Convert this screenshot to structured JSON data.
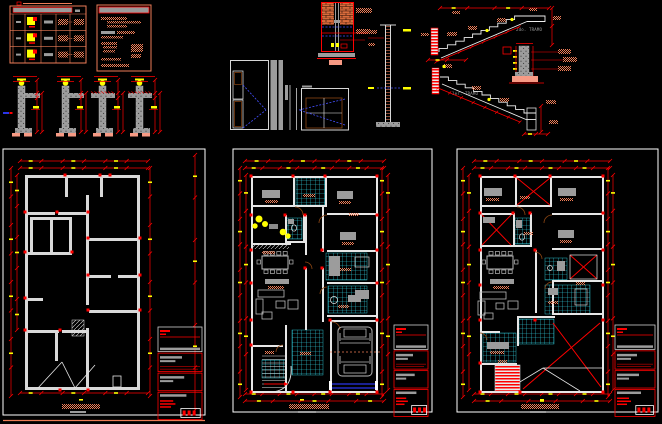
{
  "canvas": {
    "width": 662,
    "height": 424,
    "background": "#000000"
  },
  "palette": {
    "background": "#000000",
    "red": "#ff0000",
    "label_orange": "#ee7d57",
    "brick_orange": "#d96c3c",
    "salmon": "#f79a84",
    "yellow": "#ffff00",
    "cyan": "#35e0f2",
    "blue": "#2a35e8",
    "dash_blue": "#4450ff",
    "white": "#ffffff",
    "wall_white": "#e6e6e6",
    "gray": "#9d9d9d",
    "furniture_gray": "#b8b8b8",
    "dark_gray": "#6f6f6f",
    "maroon": "#8b4513",
    "text_gray": "#9d9d9d"
  },
  "labels": {
    "stair_flight_2": "2do. TRAMO",
    "stair_flight_1": "1er. TRAMO"
  }
}
